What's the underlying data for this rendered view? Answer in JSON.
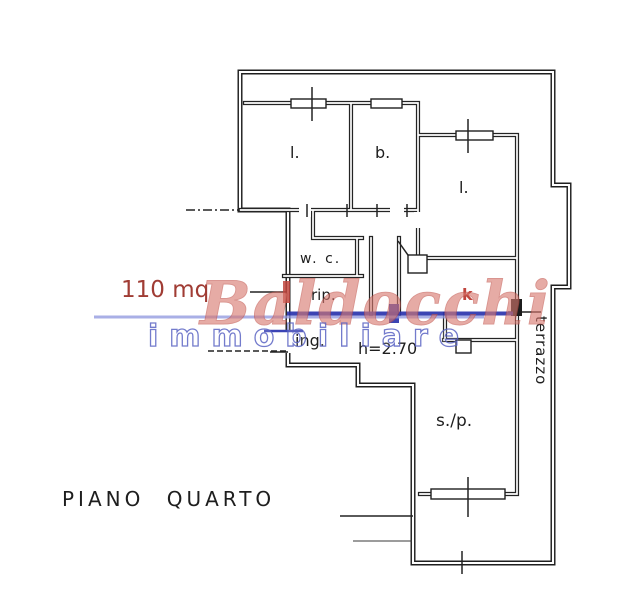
{
  "plan": {
    "title": "PIANO QUARTO",
    "area_label": "110 mq",
    "height_note": "h=2.70",
    "rooms": [
      {
        "id": "room-l-top-left",
        "label": "l."
      },
      {
        "id": "room-b",
        "label": "b."
      },
      {
        "id": "room-l-right",
        "label": "l."
      },
      {
        "id": "room-wc",
        "label": "w. c."
      },
      {
        "id": "room-rip",
        "label": "rip."
      },
      {
        "id": "room-ing",
        "label": "ing."
      },
      {
        "id": "room-k",
        "label": "k"
      },
      {
        "id": "room-sp",
        "label": "s./p."
      },
      {
        "id": "room-terrazzo",
        "label": "terrazzo"
      }
    ],
    "colors": {
      "wall": "#1f1f1f",
      "area_text": "#a03c34",
      "kitchen_label": "#c0453d",
      "entrance_blue": "#2b34ad"
    }
  },
  "watermark": {
    "line1": "Baldocchi",
    "line2": "immobiliare",
    "red": "#d8786f",
    "blue": "#6b74cf",
    "underline": "#8c94dd"
  }
}
